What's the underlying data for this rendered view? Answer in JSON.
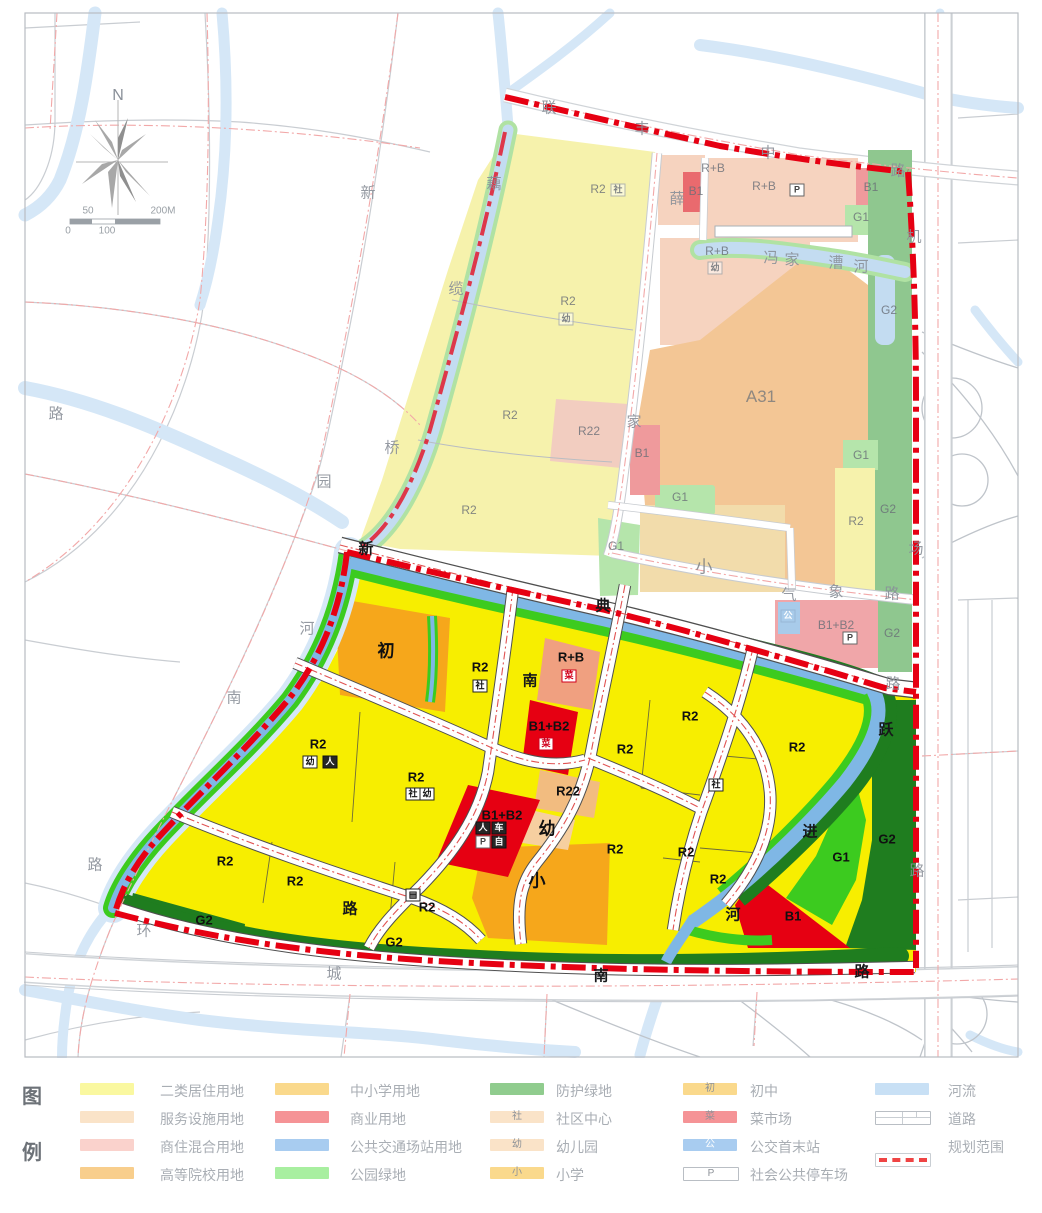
{
  "map": {
    "labels": [
      {
        "t": "N",
        "x": 118,
        "y": 96,
        "c": "cn"
      },
      {
        "t": "50",
        "x": 88,
        "y": 211,
        "c": "st"
      },
      {
        "t": "200M",
        "x": 163,
        "y": 211,
        "c": "st"
      },
      {
        "t": "0",
        "x": 68,
        "y": 231,
        "c": "st"
      },
      {
        "t": "100",
        "x": 107,
        "y": 231,
        "c": "st"
      },
      {
        "t": "联",
        "x": 549,
        "y": 107,
        "c": "rg"
      },
      {
        "t": "丰",
        "x": 642,
        "y": 128,
        "c": "rg"
      },
      {
        "t": "中",
        "x": 768,
        "y": 152,
        "c": "rg"
      },
      {
        "t": "路",
        "x": 898,
        "y": 170,
        "c": "rg"
      },
      {
        "t": "机",
        "x": 914,
        "y": 236,
        "c": "rg"
      },
      {
        "t": "场",
        "x": 916,
        "y": 548,
        "c": "rg"
      },
      {
        "t": "路",
        "x": 917,
        "y": 870,
        "c": "rg"
      },
      {
        "t": "气",
        "x": 789,
        "y": 594,
        "c": "rg"
      },
      {
        "t": "象",
        "x": 836,
        "y": 591,
        "c": "rg"
      },
      {
        "t": "路",
        "x": 892,
        "y": 593,
        "c": "rg"
      },
      {
        "t": "新",
        "x": 368,
        "y": 192,
        "c": "rg"
      },
      {
        "t": "薛",
        "x": 677,
        "y": 198,
        "c": "rg"
      },
      {
        "t": "家",
        "x": 634,
        "y": 421,
        "c": "rg"
      },
      {
        "t": "路",
        "x": 893,
        "y": 683,
        "c": "rg"
      },
      {
        "t": "园",
        "x": 324,
        "y": 481,
        "c": "rg"
      },
      {
        "t": "南",
        "x": 234,
        "y": 697,
        "c": "rg"
      },
      {
        "t": "路",
        "x": 95,
        "y": 864,
        "c": "rg"
      },
      {
        "t": "路",
        "x": 56,
        "y": 413,
        "c": "rg"
      },
      {
        "t": "环",
        "x": 144,
        "y": 930,
        "c": "rg"
      },
      {
        "t": "城",
        "x": 334,
        "y": 973,
        "c": "rg"
      },
      {
        "t": "藕",
        "x": 494,
        "y": 183,
        "c": "rg"
      },
      {
        "t": "缆",
        "x": 456,
        "y": 288,
        "c": "rg"
      },
      {
        "t": "桥",
        "x": 392,
        "y": 447,
        "c": "rg"
      },
      {
        "t": "河",
        "x": 307,
        "y": 628,
        "c": "rg"
      },
      {
        "t": "冯",
        "x": 771,
        "y": 257,
        "c": "rg"
      },
      {
        "t": "家",
        "x": 792,
        "y": 259,
        "c": "rg"
      },
      {
        "t": "漕",
        "x": 836,
        "y": 262,
        "c": "rg"
      },
      {
        "t": "河",
        "x": 861,
        "y": 266,
        "c": "rg"
      },
      {
        "t": "新",
        "x": 366,
        "y": 548,
        "c": "rb"
      },
      {
        "t": "典",
        "x": 603,
        "y": 605,
        "c": "rb"
      },
      {
        "t": "南",
        "x": 530,
        "y": 680,
        "c": "rb"
      },
      {
        "t": "路",
        "x": 350,
        "y": 908,
        "c": "rb"
      },
      {
        "t": "南",
        "x": 601,
        "y": 975,
        "c": "rb"
      },
      {
        "t": "路",
        "x": 862,
        "y": 971,
        "c": "rb"
      },
      {
        "t": "跃",
        "x": 886,
        "y": 729,
        "c": "rb"
      },
      {
        "t": "进",
        "x": 810,
        "y": 831,
        "c": "rb"
      },
      {
        "t": "河",
        "x": 733,
        "y": 914,
        "c": "rb"
      },
      {
        "t": "R2",
        "x": 598,
        "y": 189,
        "c": "zf"
      },
      {
        "t": "R2",
        "x": 568,
        "y": 301,
        "c": "zf"
      },
      {
        "t": "R2",
        "x": 510,
        "y": 415,
        "c": "zf"
      },
      {
        "t": "R22",
        "x": 589,
        "y": 431,
        "c": "zf"
      },
      {
        "t": "R2",
        "x": 469,
        "y": 510,
        "c": "zf"
      },
      {
        "t": "R+B",
        "x": 713,
        "y": 168,
        "c": "zf"
      },
      {
        "t": "R+B",
        "x": 764,
        "y": 186,
        "c": "zf"
      },
      {
        "t": "B1",
        "x": 871,
        "y": 187,
        "c": "zf"
      },
      {
        "t": "G1",
        "x": 861,
        "y": 217,
        "c": "zf"
      },
      {
        "t": "B1",
        "x": 696,
        "y": 191,
        "c": "zf"
      },
      {
        "t": "R+B",
        "x": 717,
        "y": 251,
        "c": "zf"
      },
      {
        "t": "B1",
        "x": 642,
        "y": 453,
        "c": "zf"
      },
      {
        "t": "G1",
        "x": 680,
        "y": 497,
        "c": "zf"
      },
      {
        "t": "G1",
        "x": 861,
        "y": 455,
        "c": "zf"
      },
      {
        "t": "R2",
        "x": 856,
        "y": 521,
        "c": "zf"
      },
      {
        "t": "G2",
        "x": 888,
        "y": 509,
        "c": "zf"
      },
      {
        "t": "G2",
        "x": 889,
        "y": 310,
        "c": "zf"
      },
      {
        "t": "G2",
        "x": 892,
        "y": 633,
        "c": "zf"
      },
      {
        "t": "G1",
        "x": 616,
        "y": 546,
        "c": "zf"
      },
      {
        "t": "B1+B2",
        "x": 836,
        "y": 625,
        "c": "zf"
      },
      {
        "t": "小",
        "x": 704,
        "y": 565,
        "c": "zfb"
      },
      {
        "t": "A31",
        "x": 761,
        "y": 397,
        "c": "zfb"
      },
      {
        "t": "社",
        "x": 618,
        "y": 190,
        "c": "bxf"
      },
      {
        "t": "幼",
        "x": 566,
        "y": 319,
        "c": "bxf"
      },
      {
        "t": "P",
        "x": 797,
        "y": 190,
        "c": "bxp"
      },
      {
        "t": "幼",
        "x": 715,
        "y": 268,
        "c": "bxf"
      },
      {
        "t": "P",
        "x": 850,
        "y": 638,
        "c": "bxp"
      },
      {
        "t": "公",
        "x": 788,
        "y": 616,
        "c": "bxfb"
      },
      {
        "t": "R2",
        "x": 480,
        "y": 667,
        "c": "z"
      },
      {
        "t": "R+B",
        "x": 571,
        "y": 657,
        "c": "z"
      },
      {
        "t": "B1+B2",
        "x": 549,
        "y": 726,
        "c": "z"
      },
      {
        "t": "R22",
        "x": 568,
        "y": 791,
        "c": "z"
      },
      {
        "t": "R2",
        "x": 318,
        "y": 744,
        "c": "z"
      },
      {
        "t": "R2",
        "x": 416,
        "y": 777,
        "c": "z"
      },
      {
        "t": "R2",
        "x": 225,
        "y": 861,
        "c": "z"
      },
      {
        "t": "R2",
        "x": 295,
        "y": 881,
        "c": "z"
      },
      {
        "t": "R2",
        "x": 427,
        "y": 907,
        "c": "z"
      },
      {
        "t": "G2",
        "x": 204,
        "y": 920,
        "c": "z"
      },
      {
        "t": "G2",
        "x": 394,
        "y": 942,
        "c": "z"
      },
      {
        "t": "R2",
        "x": 625,
        "y": 749,
        "c": "z"
      },
      {
        "t": "R2",
        "x": 690,
        "y": 716,
        "c": "z"
      },
      {
        "t": "R2",
        "x": 797,
        "y": 747,
        "c": "z"
      },
      {
        "t": "R2",
        "x": 615,
        "y": 849,
        "c": "z"
      },
      {
        "t": "R2",
        "x": 686,
        "y": 852,
        "c": "z"
      },
      {
        "t": "R2",
        "x": 718,
        "y": 879,
        "c": "z"
      },
      {
        "t": "G1",
        "x": 841,
        "y": 857,
        "c": "z"
      },
      {
        "t": "G2",
        "x": 887,
        "y": 839,
        "c": "z"
      },
      {
        "t": "B1",
        "x": 793,
        "y": 916,
        "c": "z"
      },
      {
        "t": "B1+B2",
        "x": 502,
        "y": 815,
        "c": "z"
      },
      {
        "t": "初",
        "x": 386,
        "y": 649,
        "c": "zb"
      },
      {
        "t": "小",
        "x": 537,
        "y": 879,
        "c": "zb"
      },
      {
        "t": "幼",
        "x": 547,
        "y": 827,
        "c": "zb"
      },
      {
        "t": "社",
        "x": 480,
        "y": 686,
        "c": "bx"
      },
      {
        "t": "菜",
        "x": 569,
        "y": 676,
        "c": "bxr"
      },
      {
        "t": "菜",
        "x": 546,
        "y": 744,
        "c": "bxr"
      },
      {
        "t": "社",
        "x": 413,
        "y": 794,
        "c": "bx"
      },
      {
        "t": "幼",
        "x": 427,
        "y": 794,
        "c": "bx"
      },
      {
        "t": "幼",
        "x": 310,
        "y": 762,
        "c": "bx"
      },
      {
        "t": "人",
        "x": 330,
        "y": 762,
        "c": "bxd"
      },
      {
        "t": "社",
        "x": 716,
        "y": 785,
        "c": "bx"
      },
      {
        "t": "▤",
        "x": 413,
        "y": 895,
        "c": "bx"
      },
      {
        "t": "人",
        "x": 483,
        "y": 828,
        "c": "bxd"
      },
      {
        "t": "车",
        "x": 499,
        "y": 828,
        "c": "bxd"
      },
      {
        "t": "P",
        "x": 483,
        "y": 842,
        "c": "bxp"
      },
      {
        "t": "自",
        "x": 499,
        "y": 842,
        "c": "bxd"
      }
    ]
  },
  "legend": {
    "title_chars": [
      "图",
      "例"
    ],
    "columns": [
      {
        "items": [
          {
            "label": "二类居住用地",
            "swatch": "fill",
            "color": "#faf8a0"
          },
          {
            "label": "服务设施用地",
            "swatch": "fill",
            "color": "#fae3c8"
          },
          {
            "label": "商住混合用地",
            "swatch": "fill",
            "color": "#fad2cc"
          },
          {
            "label": "高等院校用地",
            "swatch": "fill",
            "color": "#f8ce8c"
          }
        ]
      },
      {
        "items": [
          {
            "label": "中小学用地",
            "swatch": "fill",
            "color": "#fad98c"
          },
          {
            "label": "商业用地",
            "swatch": "fill",
            "color": "#f59396"
          },
          {
            "label": "公共交通场站用地",
            "swatch": "fill",
            "color": "#a8ccf0"
          },
          {
            "label": "公园绿地",
            "swatch": "fill",
            "color": "#a8efa0"
          }
        ]
      },
      {
        "items": [
          {
            "label": "防护绿地",
            "swatch": "fill",
            "color": "#90cc8e"
          },
          {
            "label": "社区中心",
            "swatch": "char",
            "color": "#fae3c8",
            "char": "社"
          },
          {
            "label": "幼儿园",
            "swatch": "char",
            "color": "#fae3c8",
            "char": "幼"
          },
          {
            "label": "小学",
            "swatch": "char",
            "color": "#fad98c",
            "char": "小"
          }
        ]
      },
      {
        "items": [
          {
            "label": "初中",
            "swatch": "char",
            "color": "#fad98c",
            "char": "初"
          },
          {
            "label": "菜市场",
            "swatch": "char",
            "color": "#f59396",
            "char": "菜"
          },
          {
            "label": "公交首末站",
            "swatch": "char",
            "color": "#a8ccf0",
            "char": "公",
            "char_color": "#ffffff"
          },
          {
            "label": "社会公共停车场",
            "swatch": "char",
            "color": "#ffffff",
            "char": "P",
            "border": true
          }
        ]
      },
      {
        "items": [
          {
            "label": "河流",
            "swatch": "fill",
            "color": "#c8e0f5"
          },
          {
            "label": "道路",
            "swatch": "road"
          },
          {
            "label": "规划范围",
            "swatch": "boundary"
          }
        ]
      }
    ]
  }
}
